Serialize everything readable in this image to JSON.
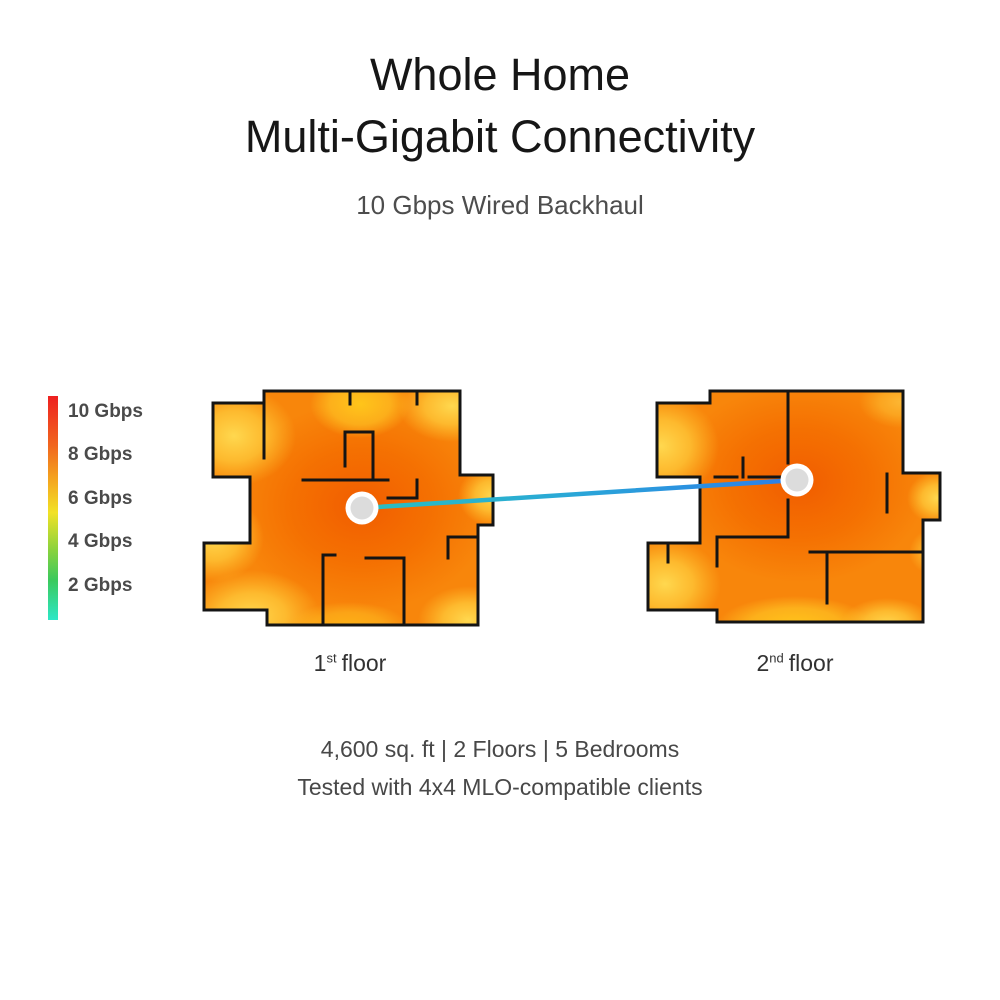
{
  "header": {
    "title_line1": "Whole Home",
    "title_line2": "Multi-Gigabit Connectivity",
    "subtitle": "10 Gbps Wired Backhaul"
  },
  "legend": {
    "items": [
      {
        "label": "10 Gbps",
        "value_gbps": 10,
        "color": "#ee2020"
      },
      {
        "label": "8 Gbps",
        "value_gbps": 8,
        "color": "#f1661f"
      },
      {
        "label": "6 Gbps",
        "value_gbps": 6,
        "color": "#f4c11f"
      },
      {
        "label": "4 Gbps",
        "value_gbps": 4,
        "color": "#5ccd4a"
      },
      {
        "label": "2 Gbps",
        "value_gbps": 2,
        "color": "#2de7c7"
      }
    ],
    "gradient_top_to_bottom": [
      "#ee2020",
      "#f1661f",
      "#f4a81f",
      "#f2e226",
      "#8ed33c",
      "#3cc95c",
      "#2de7c7"
    ]
  },
  "floors": [
    {
      "number": "1",
      "ordinal_suffix": "st",
      "label_word": "floor"
    },
    {
      "number": "2",
      "ordinal_suffix": "nd",
      "label_word": "floor"
    }
  ],
  "connection": {
    "type": "wired-backhaul-link",
    "color_start": "#29bfc0",
    "color_end": "#2c7ee9",
    "node_ring_color": "#ffffff",
    "node_fill_color": "#dcdcdc"
  },
  "heatmap_colors": {
    "hot_orange": "#f15c00",
    "base_orange": "#f8860b",
    "warm_yellow": "#ffd84f",
    "bright_yellow": "#ffc51a",
    "wall_color": "#141414"
  },
  "footer": {
    "line1": "4,600 sq. ft | 2 Floors | 5 Bedrooms",
    "line2": "Tested with 4x4 MLO-compatible clients"
  }
}
